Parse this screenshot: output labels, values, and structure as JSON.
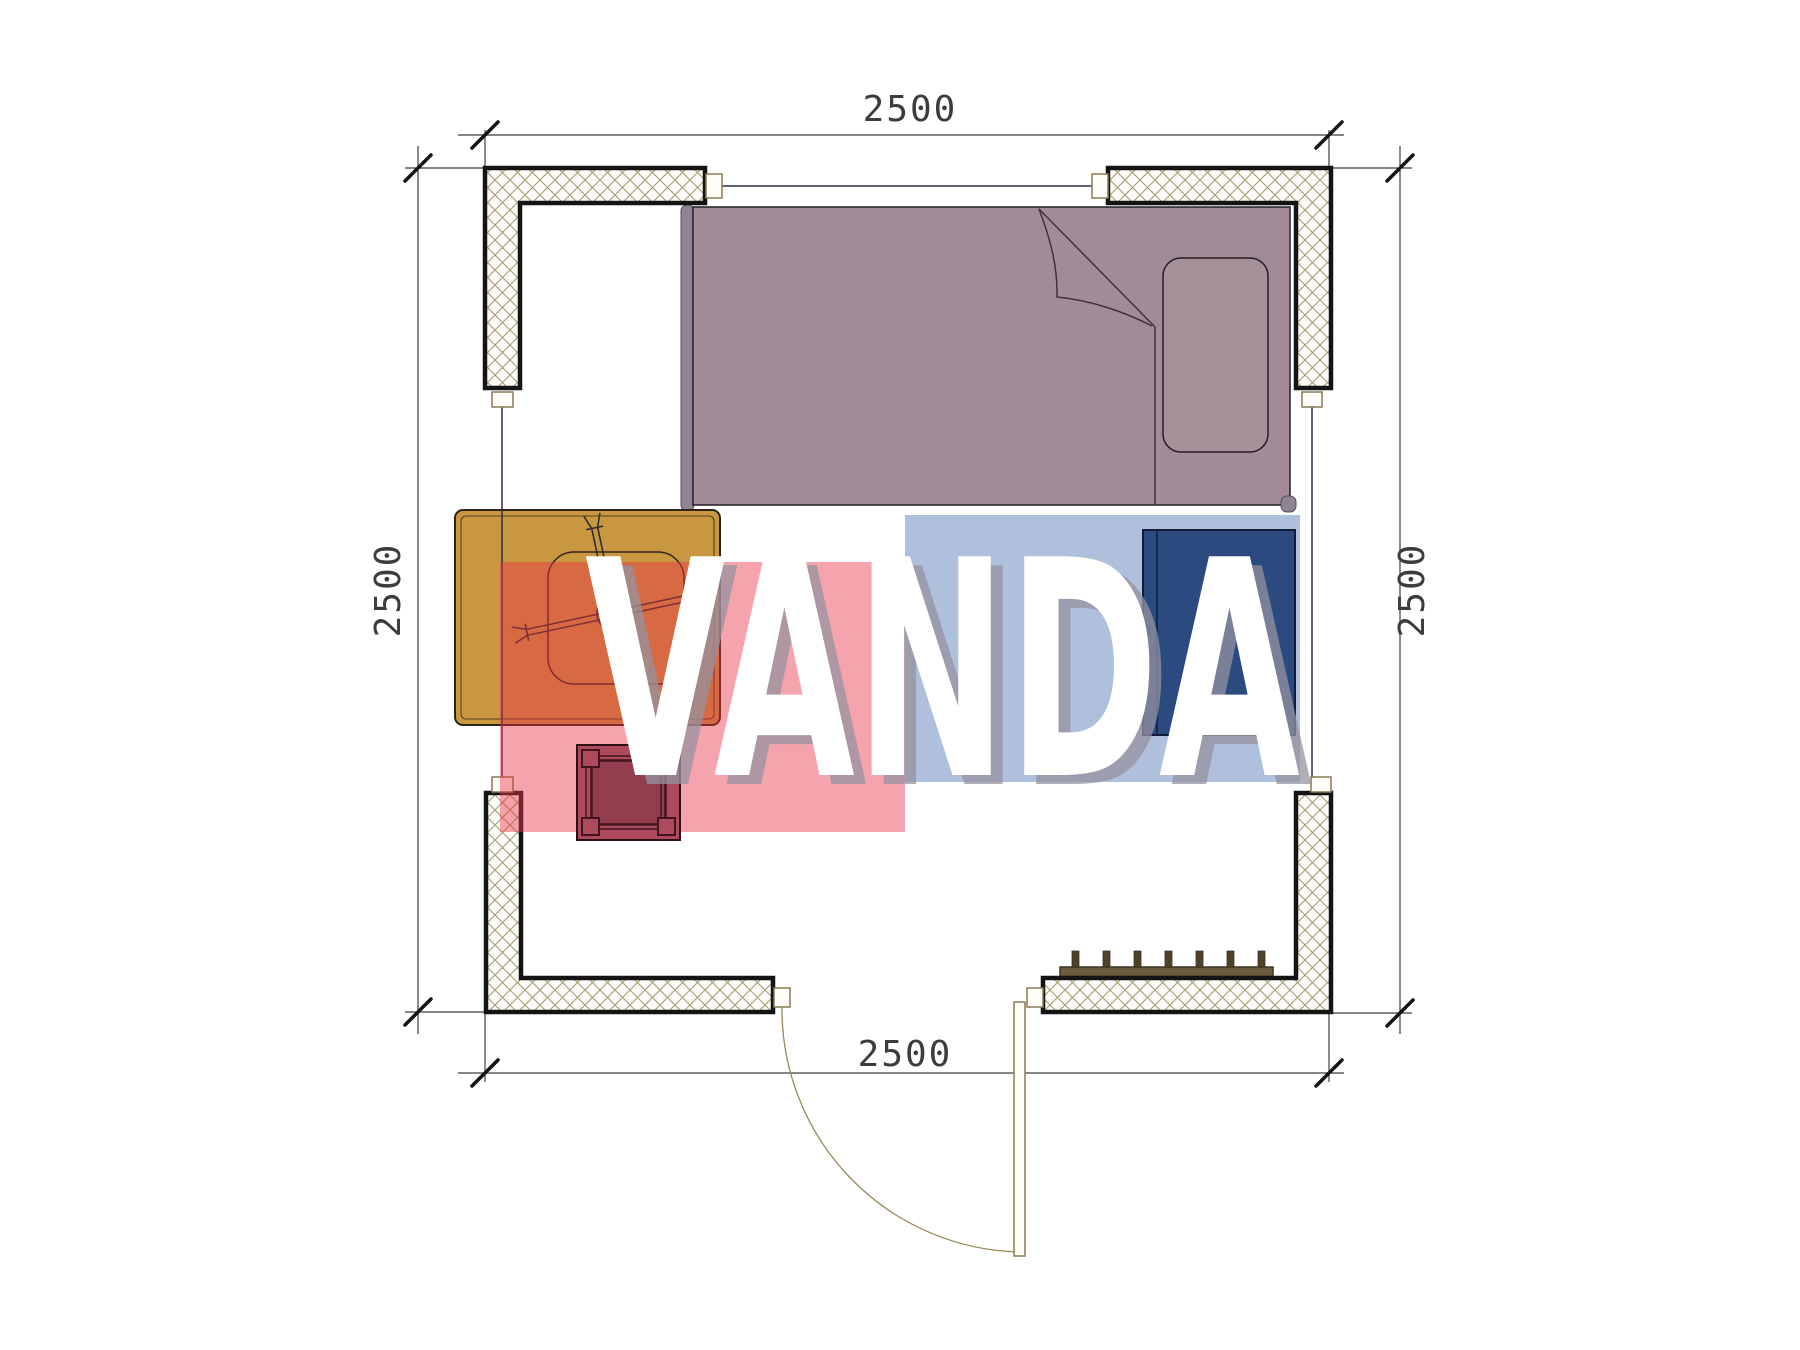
{
  "watermark": {
    "text": "VANDA",
    "text_color": "#ffffff",
    "shadow_color": "#9593a0",
    "red_block_color": "#e93448",
    "blue_block_color": "#4169af"
  },
  "dimensions": {
    "top": "2500",
    "bottom": "2500",
    "left": "2500",
    "right": "2500"
  },
  "colors": {
    "bed": "#a18b97",
    "bed_rail": "#8f8494",
    "pillow": "#a69199",
    "table": "#c9973f",
    "stool": "#ad4a5c",
    "stool_inner": "#923e4d",
    "cabinet": "#2a4a80",
    "radiator": "#6a5c3c",
    "wall_hatch": "#a89b74",
    "dimension_line": "#3d3d3d"
  }
}
